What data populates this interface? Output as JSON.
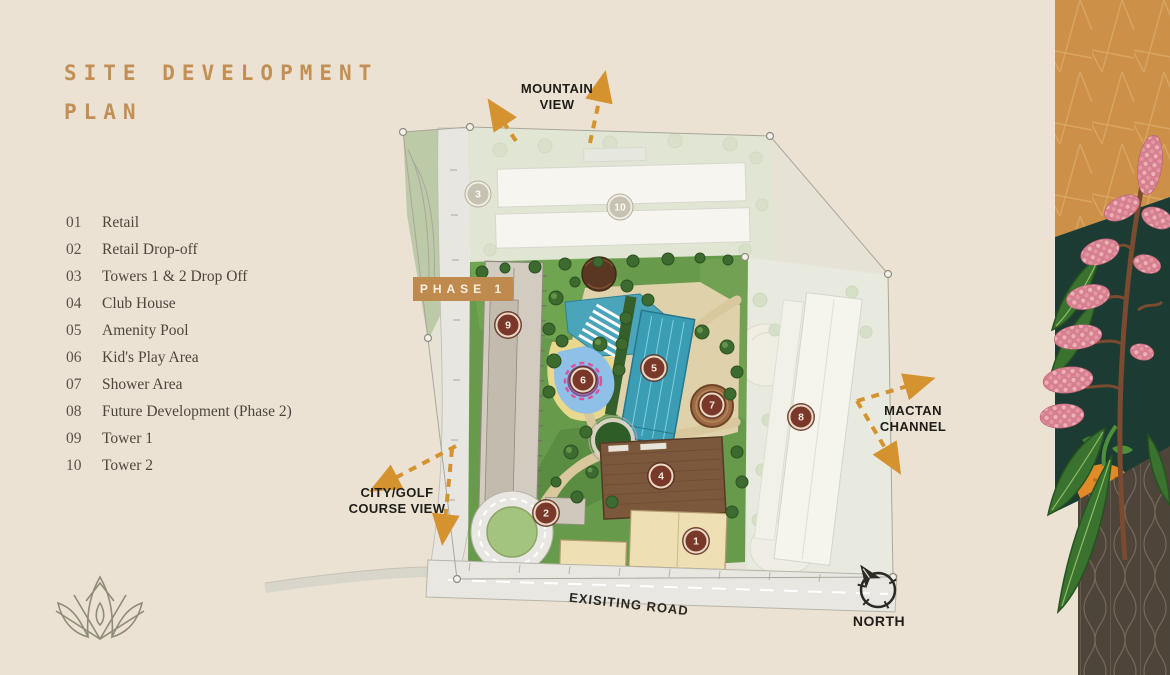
{
  "title": {
    "line1": "SITE DEVELOPMENT",
    "line2": "PLAN"
  },
  "legend": [
    {
      "num": "01",
      "label": "Retail"
    },
    {
      "num": "02",
      "label": "Retail Drop-off"
    },
    {
      "num": "03",
      "label": "Towers 1 & 2 Drop Off"
    },
    {
      "num": "04",
      "label": "Club House"
    },
    {
      "num": "05",
      "label": "Amenity Pool"
    },
    {
      "num": "06",
      "label": "Kid's Play Area"
    },
    {
      "num": "07",
      "label": "Shower Area"
    },
    {
      "num": "08",
      "label": "Future Development (Phase 2)"
    },
    {
      "num": "09",
      "label": "Tower 1"
    },
    {
      "num": "10",
      "label": "Tower 2"
    }
  ],
  "map": {
    "phase_badge": "PHASE 1",
    "road_label": "EXISITING ROAD",
    "labels": {
      "mountain_view": "MOUNTAIN\nVIEW",
      "city_golf": "CITY/GOLF\nCOURSE VIEW",
      "mactan": "MACTAN\nCHANNEL",
      "north": "NORTH"
    },
    "markers": [
      {
        "n": "1"
      },
      {
        "n": "2"
      },
      {
        "n": "3"
      },
      {
        "n": "4"
      },
      {
        "n": "5"
      },
      {
        "n": "6"
      },
      {
        "n": "7"
      },
      {
        "n": "8"
      },
      {
        "n": "9"
      },
      {
        "n": "10"
      }
    ]
  },
  "colors": {
    "background": "#ebe2d4",
    "accent_gold": "#c28f55",
    "arrow_orange": "#d4932f",
    "marker_maroon": "#7a382b",
    "phase_badge_bg": "#bf8a4e",
    "panel_orange": "#cc9049",
    "panel_teal": "#1c3b32",
    "panel_brown": "#4d443a"
  }
}
